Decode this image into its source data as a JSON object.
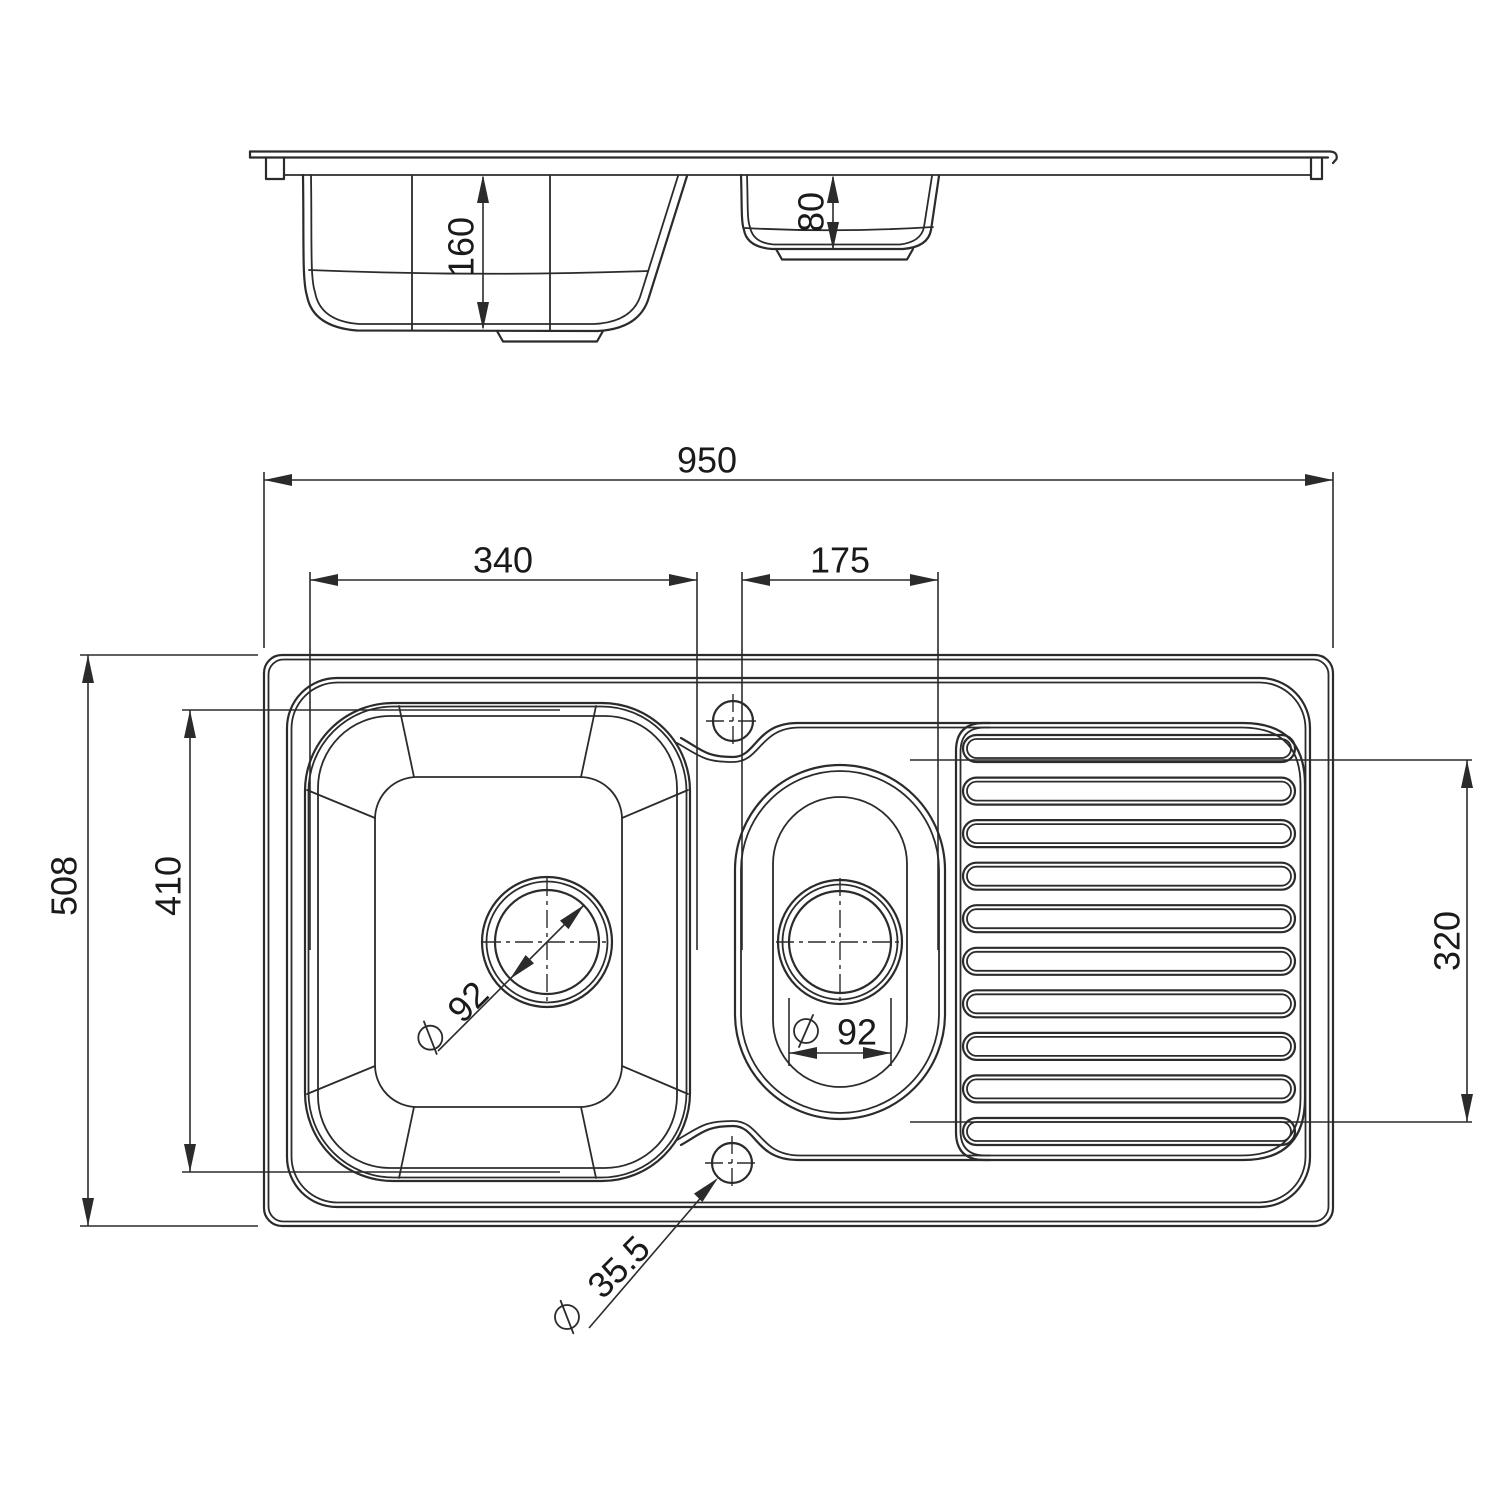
{
  "drawing": {
    "subject": "kitchen sink with one and a half bowls and drainer, dimensioned technical drawing",
    "views": [
      "side-elevation",
      "plan"
    ]
  },
  "colors": {
    "line": "#2b2b2b",
    "background": "#ffffff"
  },
  "side_view": {
    "main_bowl_depth": "160",
    "half_bowl_depth": "80"
  },
  "plan_view": {
    "overall_length": "950",
    "main_bowl_width": "340",
    "half_bowl_width": "175",
    "overall_depth": "508",
    "main_bowl_length": "410",
    "drainer_width": "320",
    "main_drain_diameter": "92",
    "half_drain_diameter": "92",
    "tap_hole_diameter": "35.5"
  }
}
